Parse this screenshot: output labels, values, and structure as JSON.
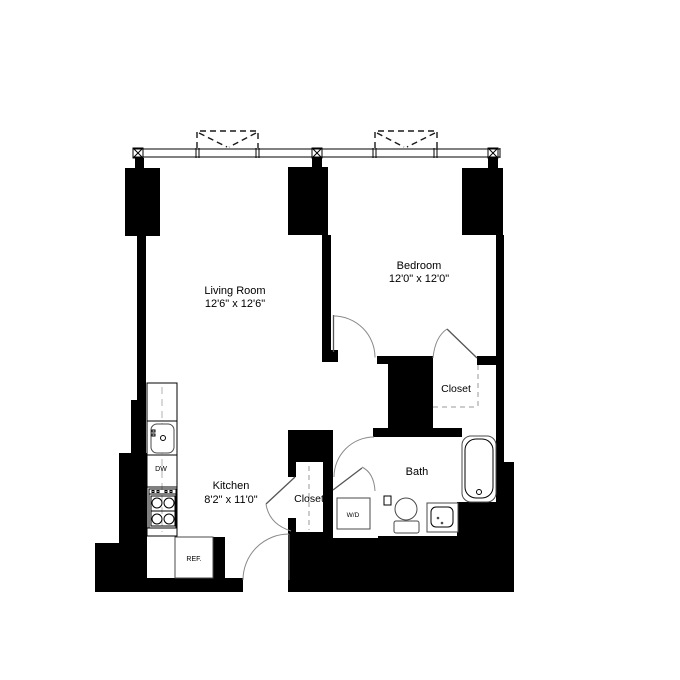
{
  "floorplan": {
    "title": "One-bedroom apartment floor plan",
    "rooms": {
      "living_room": {
        "name": "Living Room",
        "dims": "12'6\" x 12'6\""
      },
      "bedroom": {
        "name": "Bedroom",
        "dims": "12'0\" x 12'0\""
      },
      "kitchen": {
        "name": "Kitchen",
        "dims": "8'2\" x 11'0\""
      },
      "bath": {
        "name": "Bath"
      },
      "bedroom_closet": {
        "name": "Closet"
      },
      "kitchen_closet": {
        "name": "Closet"
      }
    },
    "appliances": {
      "dishwasher": "DW",
      "refrigerator": "REF.",
      "washer_dryer": "W/D"
    },
    "colors": {
      "wall": "#000000",
      "door_arc": "#8a8a8a",
      "background": "#ffffff"
    }
  }
}
